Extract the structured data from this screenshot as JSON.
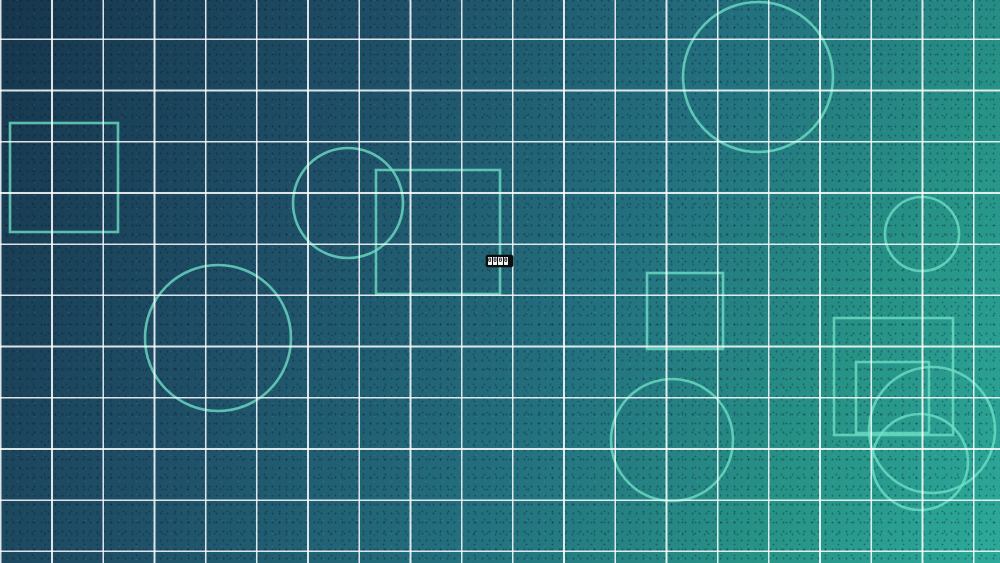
{
  "background": {
    "type": "linear-gradient",
    "angle_deg": 118,
    "stops": [
      {
        "color": "#16364d",
        "at": "0%"
      },
      {
        "color": "#1f5068",
        "at": "32%"
      },
      {
        "color": "#23707f",
        "at": "58%"
      },
      {
        "color": "#279286",
        "at": "80%"
      },
      {
        "color": "#2ca99a",
        "at": "100%"
      }
    ]
  },
  "grid": {
    "line_color": "rgba(255,255,255,0.85)",
    "line_width_px": 1.7,
    "spacing_x_px": 51.2,
    "spacing_y_px": 51.2,
    "offset_x_px": 0,
    "offset_y_px": 38.5
  },
  "shapes": {
    "stroke_color": "#6fe0c6",
    "stroke_opacity": 0.78,
    "stroke_width_px": 2.6,
    "items": [
      {
        "kind": "square",
        "x": 10,
        "y": 123,
        "w": 108,
        "h": 109
      },
      {
        "kind": "circle",
        "cx": 348,
        "cy": 203,
        "r": 55
      },
      {
        "kind": "square",
        "x": 376,
        "y": 170,
        "w": 124,
        "h": 124
      },
      {
        "kind": "circle",
        "cx": 758,
        "cy": 77,
        "r": 75
      },
      {
        "kind": "circle",
        "cx": 922,
        "cy": 234,
        "r": 37
      },
      {
        "kind": "square",
        "x": 647,
        "y": 273,
        "w": 76,
        "h": 76
      },
      {
        "kind": "circle",
        "cx": 672,
        "cy": 440,
        "r": 61
      },
      {
        "kind": "square",
        "x": 834,
        "y": 318,
        "w": 119,
        "h": 117
      },
      {
        "kind": "square",
        "x": 856,
        "y": 362,
        "w": 73,
        "h": 71
      },
      {
        "kind": "circle",
        "cx": 932,
        "cy": 430,
        "r": 63
      },
      {
        "kind": "circle",
        "cx": 920,
        "cy": 462,
        "r": 48
      },
      {
        "kind": "circle",
        "cx": 218,
        "cy": 338,
        "r": 73
      }
    ]
  },
  "counter": {
    "digits": [
      "0",
      "0",
      "0",
      "0"
    ],
    "bar_bg": "#0b0d0f",
    "cell_bg": "#f2f4f4",
    "digit_color": "#16181a",
    "position": {
      "left_px": 486,
      "top_px": 255,
      "width_px": 27,
      "height_px": 12
    }
  }
}
